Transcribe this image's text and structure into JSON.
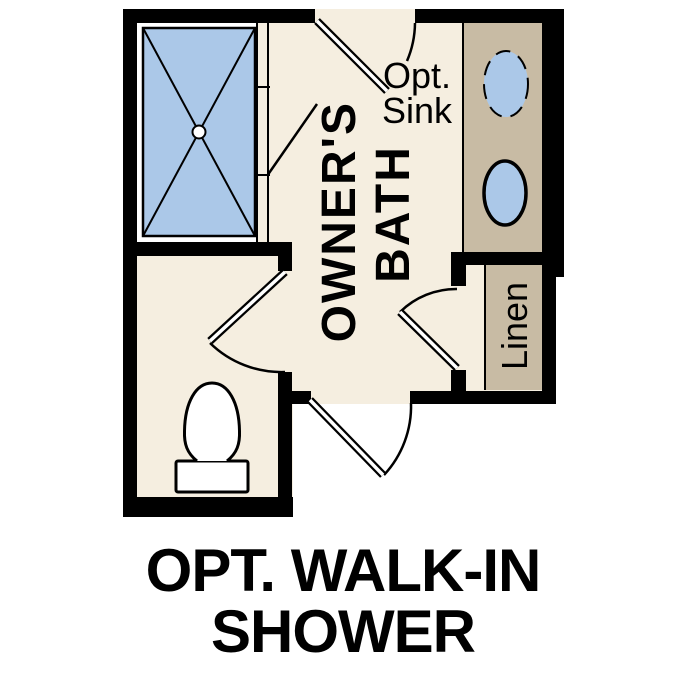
{
  "plan": {
    "labels": {
      "room_line1": "OWNER'S",
      "room_line2": "BATH",
      "opt_sink_line1": "Opt.",
      "opt_sink_line2": "Sink",
      "linen": "Linen"
    },
    "caption": {
      "line1": "OPT. WALK-IN",
      "line2": "SHOWER"
    },
    "colors": {
      "background": "#ffffff",
      "wall": "#000000",
      "floor": "#f5eee0",
      "casework": "#c8bba4",
      "fixture_blue": "#abc8e8",
      "fixture_white": "#ffffff"
    },
    "fixtures": {
      "shower": "walk-in-shower-pan",
      "sink_top": "optional-vanity-sink",
      "sink_bottom": "vanity-sink",
      "toilet": "toilet",
      "linen": "linen-shelf"
    }
  }
}
